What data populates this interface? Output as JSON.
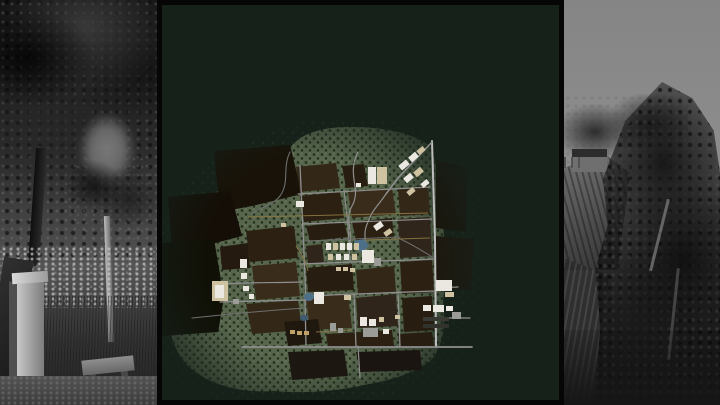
{
  "palette": {
    "panel_bg": "#16211a",
    "panel_border": "#060606",
    "terrain_green": "#57664d",
    "terrain_dot_dark": "#26331f",
    "terrain_dot_darker": "#1e2b19",
    "terrain_dot_light": "#6b7a5c",
    "sparse_dot": "#213322",
    "road_gray": "#8f8f8f",
    "road_light": "#bdbdbd",
    "road_dark": "#6e6e6e",
    "trail_yellow": "#8c7a42",
    "water_blue": "#4e6f88",
    "building_white": "#eae8e1",
    "building_tan": "#cfc2a0",
    "building_gray": "#9b9b97",
    "silo_tan": "#bfa066"
  },
  "map": {
    "terrain": {
      "main_d": "M344,127 C316,128 298,136 290,148 C262,158 240,170 224,186 C206,200 192,216 186,232 C176,248 170,262 171,278 C164,296 163,316 170,330 C174,350 184,366 200,375 C220,388 248,393 274,391 C305,394 338,391 364,385 C394,380 421,371 434,357 C443,343 446,323 443,303 C446,277 446,249 443,225 C441,197 438,167 431,147 C415,133 380,126 344,127 Z",
      "sparse_d": "M352,118 C300,118 258,132 226,154 C196,172 172,196 162,226 C148,258 146,300 154,340 C162,376 188,398 224,402 C276,408 338,404 390,396 C440,388 478,366 490,334 C500,302 500,258 492,216 C484,176 470,146 448,132 C424,116 396,116 352,118 Z"
    },
    "dark_fields": [
      {
        "p": "214,151 290,145 302,194 252,206 220,212",
        "f": "#181208"
      },
      {
        "p": "168,197 230,191 242,236 204,246 172,248",
        "f": "#140e06"
      },
      {
        "p": "158,243 214,239 224,298 218,332 162,336",
        "f": "#101006"
      },
      {
        "p": "436,160 468,167 466,232 436,228",
        "f": "#1b1208"
      },
      {
        "p": "436,236 474,239 471,290 436,288",
        "f": "#1f150b"
      }
    ],
    "plots": [
      {
        "p": "296,167 336,163 340,188 300,192",
        "f": "#332717"
      },
      {
        "p": "342,166 364,164 368,186 346,188",
        "f": "#271d10"
      },
      {
        "p": "300,196 340,192 344,218 304,222",
        "f": "#2b2012"
      },
      {
        "p": "348,192 392,188 396,214 352,218",
        "f": "#3a2c1b"
      },
      {
        "p": "398,189 428,185 430,214 400,216",
        "f": "#332717"
      },
      {
        "p": "306,226 344,222 348,237 310,241",
        "f": "#271d10"
      },
      {
        "p": "352,222 392,218 394,238 356,240",
        "f": "#2b2012"
      },
      {
        "p": "398,219 430,217 432,256 400,258",
        "f": "#30251a"
      },
      {
        "p": "246,231 294,226 298,258 250,262",
        "f": "#2b2012"
      },
      {
        "p": "252,266 296,262 300,296 256,300",
        "f": "#3a2c1b"
      },
      {
        "p": "246,304 298,300 302,330 252,334",
        "f": "#332717"
      },
      {
        "p": "306,246 322,244 324,262 308,264",
        "f": "#30251a"
      },
      {
        "p": "306,268 352,264 354,290 308,292",
        "f": "#271d10"
      },
      {
        "p": "356,270 394,266 396,292 358,294",
        "f": "#332717"
      },
      {
        "p": "400,262 432,260 434,292 402,294",
        "f": "#2b2012"
      },
      {
        "p": "306,298 348,294 352,328 310,330",
        "f": "#3a2c1b"
      },
      {
        "p": "356,298 396,294 398,326 358,328",
        "f": "#30251a"
      },
      {
        "p": "402,298 432,296 434,330 404,332",
        "f": "#271d10"
      },
      {
        "p": "284,322 318,319 322,343 288,346",
        "f": "#1f180e"
      },
      {
        "p": "326,334 392,330 394,346 328,348",
        "f": "#2b2012"
      },
      {
        "p": "398,334 432,332 434,346 400,348",
        "f": "#271d10"
      },
      {
        "p": "288,352 344,350 348,376 292,380",
        "f": "#1c1710"
      },
      {
        "p": "356,352 420,350 422,370 360,372",
        "f": "#1a1510"
      },
      {
        "p": "220,247 248,243 250,268 222,270",
        "f": "#241a10"
      }
    ],
    "roads": [
      {
        "d": "M432,141 L435,240 L436,346",
        "c": "road_light",
        "w": 2
      },
      {
        "d": "M432,142 L398,178 L386,194",
        "c": "road_gray",
        "w": 1.5
      },
      {
        "d": "M242,347 L472,347",
        "c": "road_gray",
        "w": 1.8
      },
      {
        "d": "M220,302 L306,300",
        "c": "road_gray",
        "w": 1.3
      },
      {
        "d": "M305,298 L306,347",
        "c": "road_gray",
        "w": 1.3
      },
      {
        "d": "M354,294 L356,347",
        "c": "road_gray",
        "w": 1.3
      },
      {
        "d": "M398,292 L400,347",
        "c": "road_gray",
        "w": 1.3
      },
      {
        "d": "M304,296 L434,291",
        "c": "road_gray",
        "w": 1.3
      },
      {
        "d": "M300,264 L434,259",
        "c": "road_gray",
        "w": 1.3
      },
      {
        "d": "M302,224 L432,219",
        "c": "road_gray",
        "w": 1.2
      },
      {
        "d": "M298,194 L430,187",
        "c": "road_gray",
        "w": 1.2
      },
      {
        "d": "M300,166 L303,230 L306,300",
        "c": "road_gray",
        "w": 1.3
      },
      {
        "d": "M344,190 L348,226 L350,262",
        "c": "road_gray",
        "w": 1.1
      },
      {
        "d": "M358,152 C346,176 362,188 352,206 C344,220 354,232 349,246",
        "c": "road_gray",
        "w": 1.2
      },
      {
        "d": "M220,284 C252,282 272,283 302,282",
        "c": "road_gray",
        "w": 1.2
      },
      {
        "d": "M192,318 C240,313 272,310 306,308",
        "c": "road_dark",
        "w": 1.1
      },
      {
        "d": "M290,152 C282,168 290,182 280,196 C272,206 260,207 252,214",
        "c": "road_dark",
        "w": 1.1
      },
      {
        "d": "M386,194 C378,206 372,210 368,222 C361,236 369,245 364,259",
        "c": "road_gray",
        "w": 1.2
      },
      {
        "d": "M436,288 L458,287",
        "c": "road_gray",
        "w": 1.2
      },
      {
        "d": "M436,318 L470,318",
        "c": "road_gray",
        "w": 1.2
      },
      {
        "d": "M306,241 L400,237",
        "c": "road_dark",
        "w": 1
      },
      {
        "d": "M398,238 C412,244 424,252 434,258",
        "c": "road_dark",
        "w": 1
      },
      {
        "d": "M358,346 L360,378",
        "c": "road_gray",
        "w": 1.2
      }
    ],
    "trails": [
      {
        "d": "M248,217 L428,213"
      },
      {
        "d": "M364,240 L430,238"
      },
      {
        "d": "M316,332 L352,330"
      },
      {
        "d": "M296,246 C302,254 306,262 308,271"
      }
    ],
    "ponds": [
      {
        "type": "p",
        "p": "354,241 364,239 369,246 362,252 354,249",
        "f": "water_blue"
      },
      {
        "type": "e",
        "cx": 309,
        "cy": 297,
        "rx": 5,
        "ry": 4,
        "f": "water_blue"
      },
      {
        "type": "e",
        "cx": 304,
        "cy": 318,
        "rx": 4,
        "ry": 3,
        "f": "#3f5a72"
      }
    ],
    "buildings": [
      {
        "x": 368,
        "y": 167,
        "w": 8,
        "h": 17,
        "r": 0,
        "f": "building_white"
      },
      {
        "x": 377,
        "y": 167,
        "w": 10,
        "h": 17,
        "r": 0,
        "f": "building_tan"
      },
      {
        "x": 356,
        "y": 183,
        "w": 5,
        "h": 4,
        "r": 0,
        "f": "building_white"
      },
      {
        "x": 399,
        "y": 162,
        "w": 10,
        "h": 6,
        "r": -40,
        "f": "building_white"
      },
      {
        "x": 409,
        "y": 154,
        "w": 9,
        "h": 6,
        "r": -40,
        "f": "building_white"
      },
      {
        "x": 417,
        "y": 148,
        "w": 8,
        "h": 5,
        "r": -40,
        "f": "building_tan"
      },
      {
        "x": 404,
        "y": 175,
        "w": 9,
        "h": 6,
        "r": -40,
        "f": "building_white"
      },
      {
        "x": 414,
        "y": 169,
        "w": 9,
        "h": 6,
        "r": -40,
        "f": "building_tan"
      },
      {
        "x": 421,
        "y": 181,
        "w": 8,
        "h": 5,
        "r": -40,
        "f": "building_white"
      },
      {
        "x": 407,
        "y": 189,
        "w": 8,
        "h": 5,
        "r": -40,
        "f": "building_tan"
      },
      {
        "x": 374,
        "y": 223,
        "w": 9,
        "h": 6,
        "r": -35,
        "f": "building_white"
      },
      {
        "x": 384,
        "y": 230,
        "w": 8,
        "h": 5,
        "r": -35,
        "f": "building_tan"
      },
      {
        "x": 326,
        "y": 243,
        "w": 5,
        "h": 7,
        "r": 0,
        "f": "building_white"
      },
      {
        "x": 333,
        "y": 243,
        "w": 5,
        "h": 7,
        "r": 0,
        "f": "building_tan"
      },
      {
        "x": 340,
        "y": 243,
        "w": 5,
        "h": 7,
        "r": 0,
        "f": "building_white"
      },
      {
        "x": 347,
        "y": 243,
        "w": 5,
        "h": 7,
        "r": 0,
        "f": "building_white"
      },
      {
        "x": 354,
        "y": 243,
        "w": 5,
        "h": 7,
        "r": 0,
        "f": "building_tan"
      },
      {
        "x": 328,
        "y": 254,
        "w": 5,
        "h": 6,
        "r": 0,
        "f": "building_tan"
      },
      {
        "x": 336,
        "y": 254,
        "w": 5,
        "h": 6,
        "r": 0,
        "f": "building_white"
      },
      {
        "x": 344,
        "y": 254,
        "w": 5,
        "h": 6,
        "r": 0,
        "f": "building_white"
      },
      {
        "x": 352,
        "y": 254,
        "w": 5,
        "h": 6,
        "r": 0,
        "f": "building_tan"
      },
      {
        "x": 362,
        "y": 250,
        "w": 12,
        "h": 13,
        "r": 0,
        "f": "building_white"
      },
      {
        "x": 374,
        "y": 258,
        "w": 7,
        "h": 8,
        "r": 0,
        "f": "building_gray"
      },
      {
        "x": 336,
        "y": 267,
        "w": 5,
        "h": 4,
        "r": 0,
        "f": "building_tan"
      },
      {
        "x": 343,
        "y": 267,
        "w": 5,
        "h": 4,
        "r": 0,
        "f": "building_tan"
      },
      {
        "x": 350,
        "y": 268,
        "w": 5,
        "h": 4,
        "r": 0,
        "f": "building_tan"
      },
      {
        "x": 212,
        "y": 281,
        "w": 16,
        "h": 20,
        "r": 0,
        "f": "building_tan"
      },
      {
        "x": 215,
        "y": 285,
        "w": 9,
        "h": 13,
        "r": 0,
        "f": "building_white"
      },
      {
        "x": 240,
        "y": 259,
        "w": 7,
        "h": 9,
        "r": 0,
        "f": "building_white"
      },
      {
        "x": 241,
        "y": 273,
        "w": 6,
        "h": 6,
        "r": 0,
        "f": "building_white"
      },
      {
        "x": 243,
        "y": 286,
        "w": 6,
        "h": 5,
        "r": 0,
        "f": "building_white"
      },
      {
        "x": 249,
        "y": 294,
        "w": 5,
        "h": 5,
        "r": 0,
        "f": "building_white"
      },
      {
        "x": 233,
        "y": 299,
        "w": 6,
        "h": 5,
        "r": 0,
        "f": "building_gray"
      },
      {
        "x": 296,
        "y": 201,
        "w": 8,
        "h": 6,
        "r": 0,
        "f": "building_white"
      },
      {
        "x": 281,
        "y": 223,
        "w": 5,
        "h": 4,
        "r": 0,
        "f": "building_tan"
      },
      {
        "x": 314,
        "y": 292,
        "w": 10,
        "h": 12,
        "r": 0,
        "f": "building_white"
      },
      {
        "x": 344,
        "y": 295,
        "w": 7,
        "h": 5,
        "r": 0,
        "f": "building_tan"
      },
      {
        "x": 436,
        "y": 280,
        "w": 16,
        "h": 11,
        "r": 0,
        "f": "building_white"
      },
      {
        "x": 445,
        "y": 292,
        "w": 9,
        "h": 5,
        "r": 0,
        "f": "building_tan"
      },
      {
        "x": 423,
        "y": 305,
        "w": 8,
        "h": 6,
        "r": 0,
        "f": "building_white"
      },
      {
        "x": 433,
        "y": 305,
        "w": 11,
        "h": 7,
        "r": 0,
        "f": "building_white"
      },
      {
        "x": 446,
        "y": 306,
        "w": 7,
        "h": 5,
        "r": 0,
        "f": "building_white"
      },
      {
        "x": 452,
        "y": 312,
        "w": 9,
        "h": 7,
        "r": 0,
        "f": "building_gray"
      },
      {
        "x": 423,
        "y": 317,
        "w": 26,
        "h": 4,
        "r": 0,
        "f": "#3a3a34"
      },
      {
        "x": 423,
        "y": 324,
        "w": 26,
        "h": 4,
        "r": 0,
        "f": "#32322c"
      },
      {
        "x": 360,
        "y": 317,
        "w": 7,
        "h": 9,
        "r": 0,
        "f": "building_white"
      },
      {
        "x": 369,
        "y": 319,
        "w": 7,
        "h": 7,
        "r": 0,
        "f": "building_white"
      },
      {
        "x": 379,
        "y": 317,
        "w": 5,
        "h": 5,
        "r": 0,
        "f": "building_tan"
      },
      {
        "x": 363,
        "y": 328,
        "w": 15,
        "h": 9,
        "r": 0,
        "f": "building_gray"
      },
      {
        "x": 383,
        "y": 329,
        "w": 6,
        "h": 5,
        "r": 0,
        "f": "building_white"
      },
      {
        "x": 395,
        "y": 315,
        "w": 5,
        "h": 4,
        "r": 0,
        "f": "building_tan"
      },
      {
        "x": 330,
        "y": 323,
        "w": 6,
        "h": 8,
        "r": 0,
        "f": "building_gray"
      },
      {
        "x": 338,
        "y": 328,
        "w": 5,
        "h": 5,
        "r": 0,
        "f": "building_gray"
      },
      {
        "x": 290,
        "y": 330,
        "w": 5,
        "h": 4,
        "r": 0,
        "f": "silo_tan"
      },
      {
        "x": 297,
        "y": 331,
        "w": 5,
        "h": 4,
        "r": 0,
        "f": "silo_tan"
      },
      {
        "x": 304,
        "y": 331,
        "w": 5,
        "h": 4,
        "r": 0,
        "f": "silo_tan"
      }
    ]
  }
}
